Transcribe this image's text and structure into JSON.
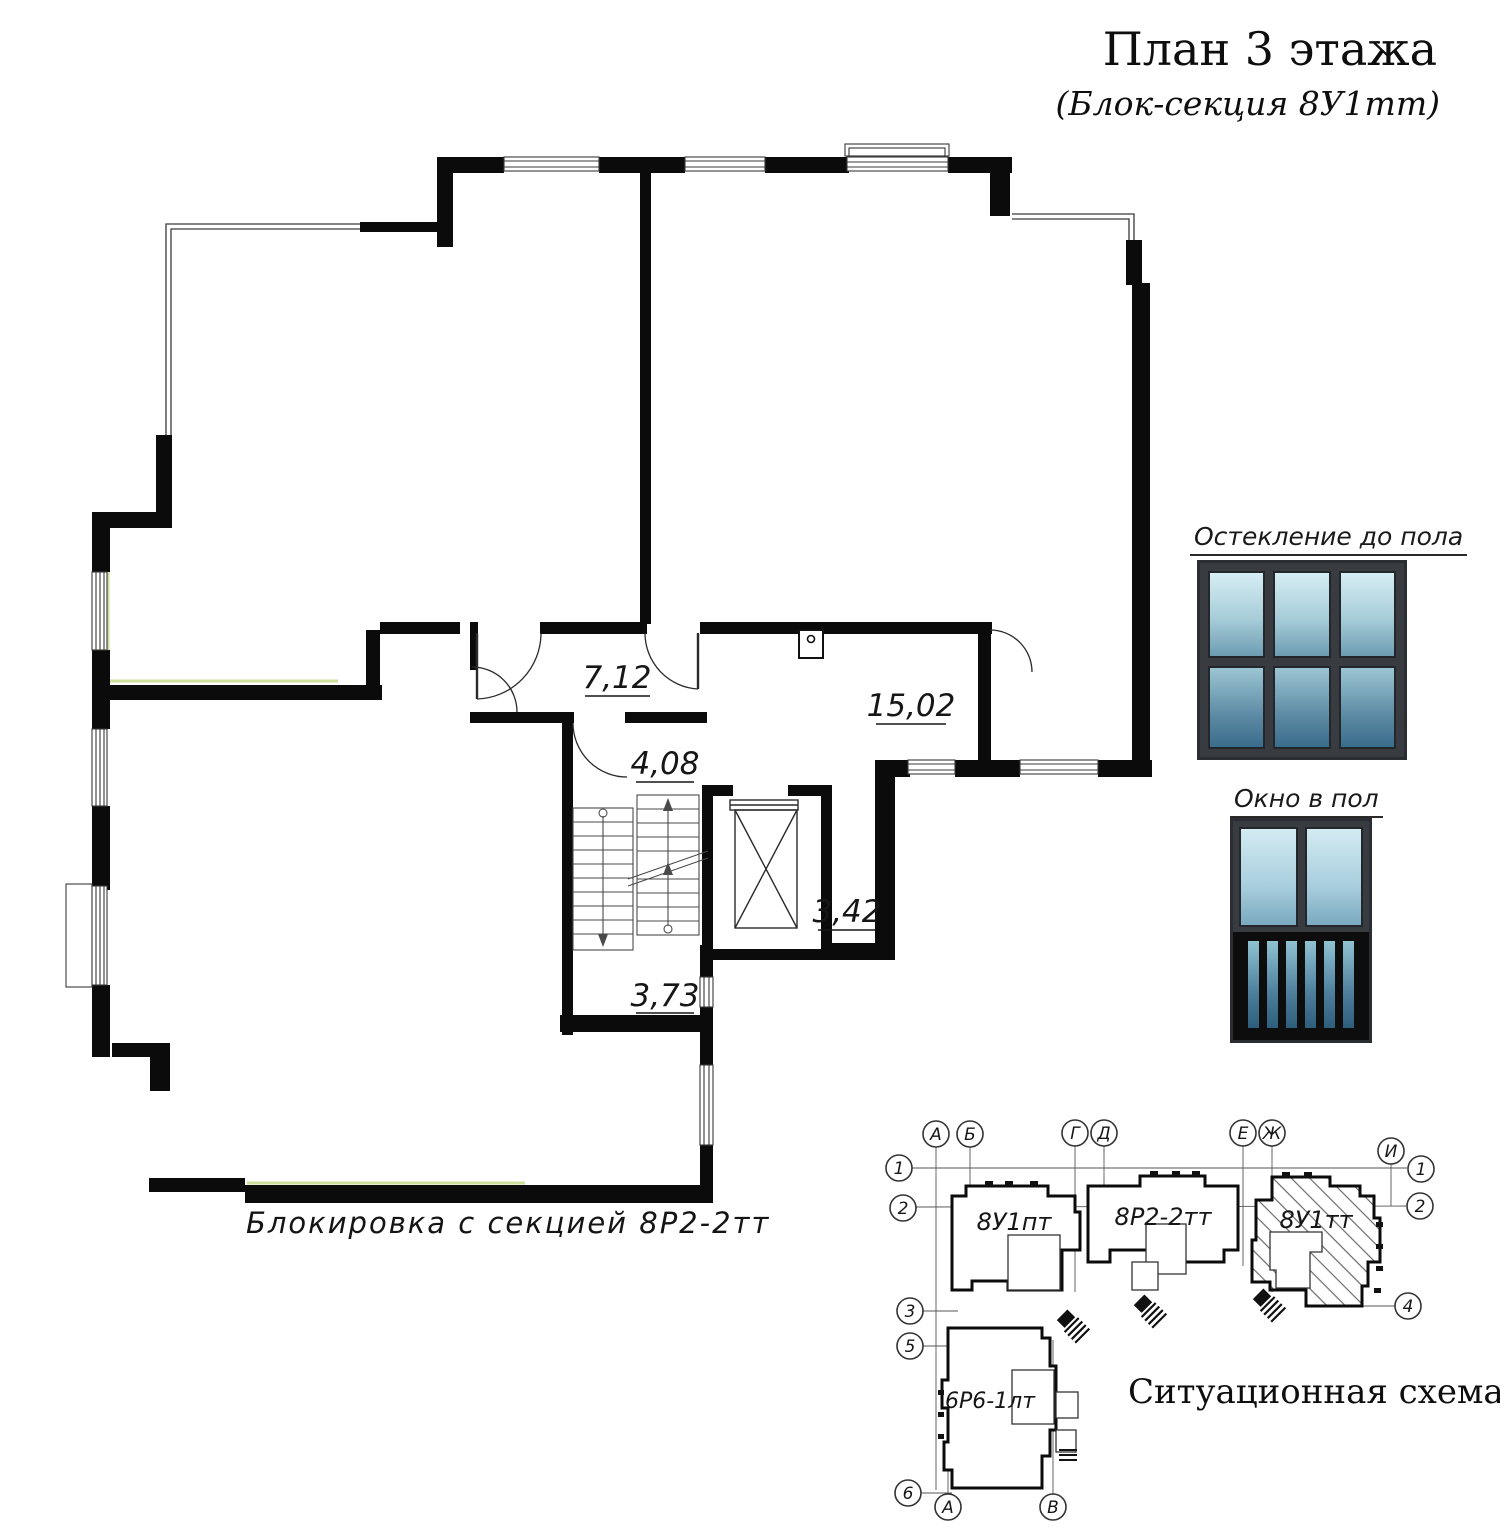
{
  "title": "План 3 этажа",
  "subtitle": "(Блок-секция 8У1тт)",
  "plan": {
    "note": "Блокировка с секцией 8Р2-2тт",
    "areas": [
      {
        "id": "hall",
        "value": "7,12"
      },
      {
        "id": "room-right",
        "value": "15,02"
      },
      {
        "id": "stair-lobby",
        "value": "4,08"
      },
      {
        "id": "elevator-hall",
        "value": "3,42"
      },
      {
        "id": "corridor",
        "value": "3,73"
      }
    ]
  },
  "legend": {
    "full_glazing_label": "Остекление до пола",
    "floor_window_label": "Окно в пол"
  },
  "scheme": {
    "title": "Ситуационная схема",
    "sections": [
      {
        "label": "8У1пт",
        "highlighted": false
      },
      {
        "label": "8Р2-2тт",
        "highlighted": false
      },
      {
        "label": "8У1тт",
        "highlighted": true
      },
      {
        "label": "6Р6-1лт",
        "highlighted": false
      }
    ],
    "axis_labels": [
      "А",
      "Б",
      "Г",
      "Д",
      "Е",
      "Ж",
      "И",
      "1",
      "2",
      "1",
      "2",
      "3",
      "5",
      "4",
      "6",
      "А",
      "В"
    ]
  },
  "colors": {
    "wall": "#0b0b0b",
    "thin_line": "#3a3a3a",
    "glazing_accent": "#ccdf9b",
    "legend_frame": "#383c41",
    "glass_light": "#d6edf4",
    "glass_dark": "#3a6d8c"
  }
}
